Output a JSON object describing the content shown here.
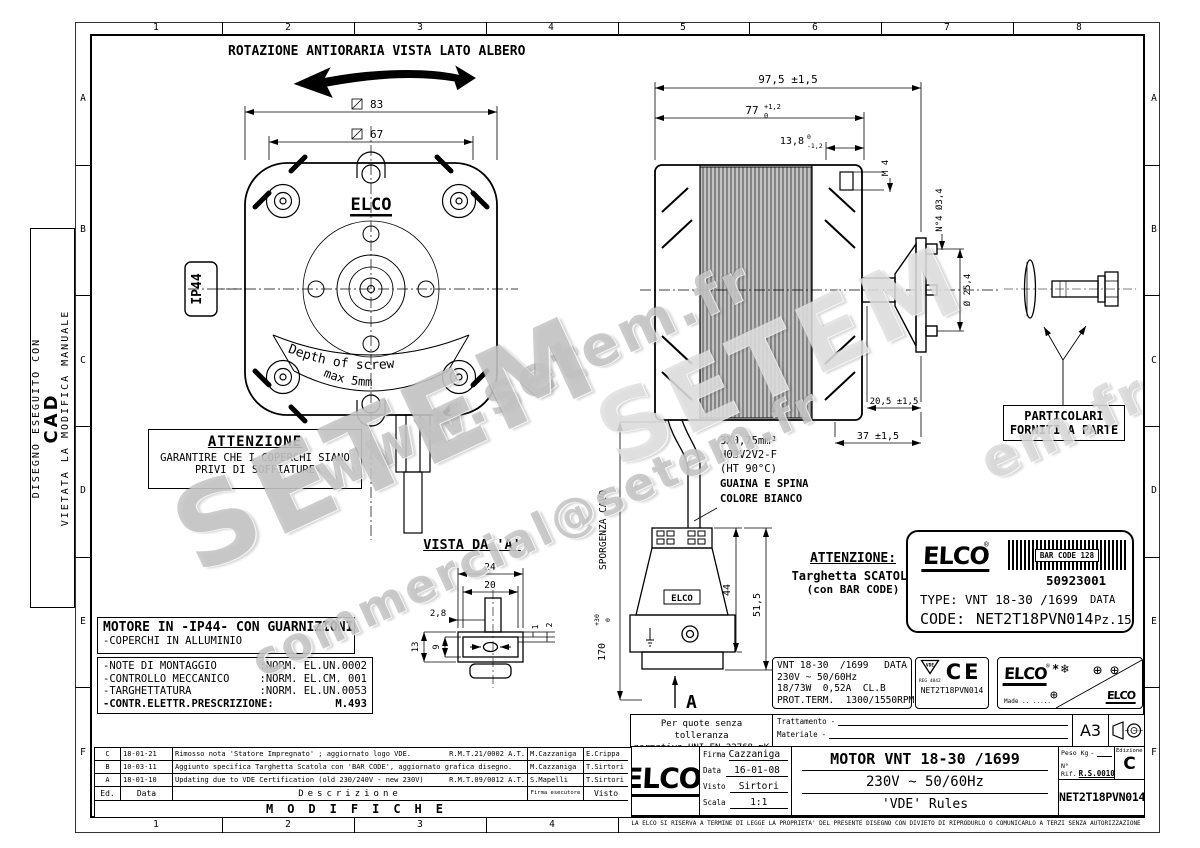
{
  "frame": {
    "top_numbers": [
      "1",
      "2",
      "3",
      "4",
      "5",
      "6",
      "7",
      "8"
    ],
    "bottom_numbers": [
      "1",
      "2",
      "3",
      "4"
    ],
    "left_letters": [
      "A",
      "B",
      "C",
      "D",
      "E",
      "F"
    ],
    "right_letters": [
      "A",
      "B",
      "C",
      "D",
      "E",
      "F"
    ],
    "disclaimer": "LA ELCO SI RISERVA A TERMINE DI LEGGE LA PROPRIETA' DEL PRESENTE DISEGNO CON DIVIETO DI RIPRODURLO O COMUNICARLO A TERZI SENZA AUTORIZZAZIONE",
    "cad_note_line1": "DISEGNO ESEGUITO CON",
    "cad_note_big": "CAD",
    "cad_note_line2": "VIETATA LA MODIFICA MANUALE"
  },
  "watermarks": {
    "w1": "www.setem.fr",
    "w2": "SETEM",
    "w3": "SETEM",
    "w4": "commercial@setem.fr",
    "w5": "em.fr"
  },
  "front_view": {
    "rotation_note": "ROTAZIONE ANTIORARIA VISTA LATO ALBERO",
    "dim_83": "83",
    "dim_67": "67",
    "ip_label": "IP44",
    "logo": "ELCO",
    "screw_note_line1": "Depth of screw",
    "screw_note_line2": "max 5mm"
  },
  "warning_box": {
    "title": "ATTENZIONE",
    "line1": "GARANTIRE CHE I COPERCHI SIANO",
    "line2": "PRIVI DI SOFFIATURE"
  },
  "side_view": {
    "dim_overall": "97,5 ±1,5",
    "dim_77": "77",
    "dim_77_tol_up": "+1,2",
    "dim_77_tol_dn": "0",
    "dim_138": "13,8",
    "dim_138_tol_up": "0",
    "dim_138_tol_dn": "-1,2",
    "dim_m4": "M 4",
    "dim_holes": "N°4 Ø3,4",
    "dim_pcd": "Ø 25,4",
    "dim_205": "20,5 ±1,5",
    "dim_37": "37 ±1,5"
  },
  "cable": {
    "spec_line1": "3X0,75mm²",
    "spec_line2": "H03V2V2-F",
    "spec_line3": "(HT 90°C)",
    "spec_line4": "GUAINA E SPINA",
    "spec_line5": "COLORE BIANCO",
    "sporgenza_label": "SPORGENZA CAVO",
    "dim_170": "170",
    "dim_170_tol_up": "+30",
    "dim_170_tol_dn": "0",
    "dim_44": "44",
    "dim_515": "51,5",
    "plug_logo": "ELCO",
    "view_arrow_label": "A"
  },
  "label_warning": {
    "title": "ATTENZIONE:",
    "line1": "Targhetta SCATOLA",
    "line2": "(con BAR CODE)"
  },
  "elco_label": {
    "logo": "ELCO",
    "reg": "®",
    "barcode_text": "BAR CODE 128",
    "barcode_number": "50923001",
    "type_label": "TYPE:",
    "type_value": "VNT 18-30 /1699",
    "data_label": "DATA",
    "code_label": "CODE:",
    "code_value": "NET2T18PVN014",
    "qty": "Pz.15"
  },
  "spare_parts": {
    "line1": "PARTICOLARI",
    "line2": "FORNITI A PARTE"
  },
  "vista_a": {
    "title": "VISTA DA 'A'",
    "dim_24": "24",
    "dim_20": "20",
    "dim_28": "2,8",
    "dim_13": "13",
    "dim_9": "9",
    "dim_1": "1",
    "dim_2": "2"
  },
  "motor_spec": {
    "title": "MOTORE IN -IP44- CON GUARNIZIONI",
    "subtitle": "-COPERCHI IN ALLUMINIO",
    "rows": [
      {
        "label": "-NOTE DI MONTAGGIO",
        "value": ":NORM. EL.UN.0002"
      },
      {
        "label": "-CONTROLLO MECCANICO",
        "value": ":NORM. EL.CM. 001"
      },
      {
        "label": "-TARGHETTATURA",
        "value": ":NORM. EL.UN.0053"
      },
      {
        "label": "-CONTR.ELETTR.PRESCRIZIONE:",
        "value": "M.493"
      }
    ]
  },
  "data_plate": {
    "line1_left": "VNT 18-30  /1699",
    "line1_right": "DATA",
    "line2": "230V ~ 50/60Hz",
    "line3": "18/73W  0,52A  CL.B",
    "line4": "PROT.TERM.  1300/1550RPM"
  },
  "cert_box": {
    "vde": "VDE",
    "reg_no": "REG 4842",
    "ce": "CE",
    "code": "NET2T18PVN014"
  },
  "logos_box": {
    "logo": "ELCO",
    "reg": "®",
    "star": "*",
    "made": "Made .. .....",
    "logo_small": "ELCO"
  },
  "tolerance_box": {
    "line1": "Per quote senza tolleranza",
    "line2": "normativa UNI EN 22768-mK"
  },
  "material_box": {
    "trattamento_label": "Trattamento",
    "trattamento_value": "-",
    "materiale_label": "Materiale",
    "materiale_value": "-"
  },
  "format_box": {
    "format": "A3"
  },
  "title_block": {
    "logo": "ELCO",
    "logo_reg": "®",
    "firma_label": "Firma",
    "firma_value": "Cazzaniga",
    "data_label": "Data",
    "data_value": "16-01-08",
    "visto_label": "Visto",
    "visto_value": "Sirtori",
    "scala_label": "Scala",
    "scala_value": "1:1",
    "title_line1": "MOTOR VNT 18-30 /1699",
    "title_line2": "230V ~ 50/60Hz",
    "title_line3": "'VDE' Rules",
    "peso_label": "Peso Kg",
    "peso_value": "-",
    "rif_label": "N° Rif.",
    "rif_value": "R.S.0010/08",
    "edizione_label": "Edizione",
    "edizione_value": "C",
    "code": "NET2T18PVN014"
  },
  "revisions": {
    "header": {
      "ed": "Ed.",
      "date": "Data",
      "desc": "Descrizione",
      "firma": "Firma esecutore",
      "visto": "Visto"
    },
    "rows": [
      {
        "ed": "C",
        "date": "18-01-21",
        "desc": "Rimosso nota 'Statore Impregnato' ; aggiornato logo VDE.",
        "ref": "R.M.T.21/0002 A.T.",
        "firma": "M.Cazzaniga",
        "visto": "E.Crippa"
      },
      {
        "ed": "B",
        "date": "10-03-11",
        "desc": "Aggiunto specifica Targhetta Scatola con 'BAR CODE', aggiornato grafica disegno.",
        "ref": "",
        "firma": "M.Cazzaniga",
        "visto": "T.Sirtori"
      },
      {
        "ed": "A",
        "date": "18-01-10",
        "desc": "Updating due to VDE Certification (old 230/240V - new 230V)",
        "ref": "R.M.T.09/0012 A.T.",
        "firma": "S.Mapelli",
        "visto": "T.Sirtori"
      }
    ],
    "footer": "MODIFICHE"
  }
}
